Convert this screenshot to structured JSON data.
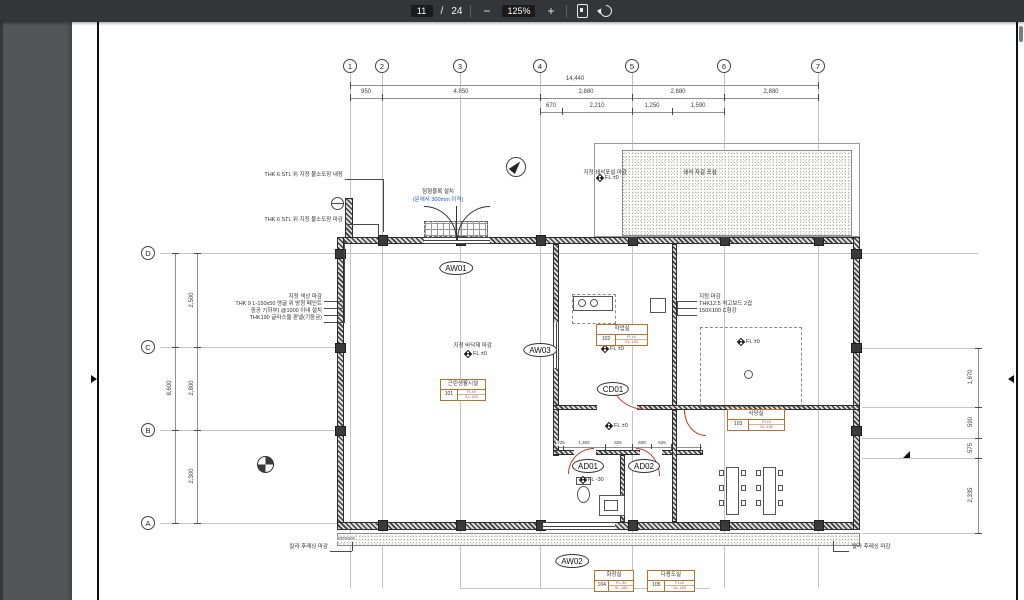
{
  "toolbar": {
    "page_current": "11",
    "page_separator": "/",
    "page_total": "24",
    "zoom_level": "125%",
    "zoom_out_label": "−",
    "zoom_in_label": "+"
  },
  "drawing": {
    "grid_cols": [
      {
        "label": "1",
        "x": 350
      },
      {
        "label": "2",
        "x": 382
      },
      {
        "label": "3",
        "x": 460
      },
      {
        "label": "4",
        "x": 540
      },
      {
        "label": "5",
        "x": 632
      },
      {
        "label": "6",
        "x": 724
      },
      {
        "label": "7",
        "x": 818
      }
    ],
    "grid_rows": [
      {
        "label": "D",
        "y": 253
      },
      {
        "label": "C",
        "y": 347
      },
      {
        "label": "B",
        "y": 430
      },
      {
        "label": "A",
        "y": 523
      }
    ],
    "dimensions": [
      {
        "t": "14,440",
        "x": 575,
        "y": 79
      },
      {
        "t": "950",
        "x": 366,
        "y": 92
      },
      {
        "t": "4,850",
        "x": 461,
        "y": 92
      },
      {
        "t": "2,880",
        "x": 586,
        "y": 92
      },
      {
        "t": "2,880",
        "x": 678,
        "y": 92
      },
      {
        "t": "2,880",
        "x": 771,
        "y": 92
      },
      {
        "t": "670",
        "x": 551,
        "y": 106
      },
      {
        "t": "2,210",
        "x": 597,
        "y": 106
      },
      {
        "t": "1,250",
        "x": 652,
        "y": 106
      },
      {
        "t": "1,590",
        "x": 698,
        "y": 106
      },
      {
        "t": "8,600",
        "x": 170,
        "y": 388,
        "rot": true
      },
      {
        "t": "2,500",
        "x": 192,
        "y": 300,
        "rot": true
      },
      {
        "t": "2,800",
        "x": 192,
        "y": 388,
        "rot": true
      },
      {
        "t": "2,300",
        "x": 192,
        "y": 476,
        "rot": true
      },
      {
        "t": "1,870",
        "x": 971,
        "y": 377,
        "rot": true
      },
      {
        "t": "590",
        "x": 971,
        "y": 422,
        "rot": true
      },
      {
        "t": "575",
        "x": 971,
        "y": 448,
        "rot": true
      },
      {
        "t": "2,335",
        "x": 971,
        "y": 495,
        "rot": true
      },
      {
        "t": "225",
        "x": 561,
        "y": 443,
        "tiny": true
      },
      {
        "t": "1,300",
        "x": 584,
        "y": 443,
        "tiny": true
      },
      {
        "t": "825",
        "x": 618,
        "y": 443,
        "tiny": true
      },
      {
        "t": "600",
        "x": 642,
        "y": 443,
        "tiny": true
      },
      {
        "t": "625",
        "x": 662,
        "y": 443,
        "tiny": true
      },
      {
        "t": "600X600",
        "x": 346,
        "y": 539,
        "tiny": true
      }
    ],
    "annotations": [
      {
        "t": "THK 6 STL 위 지정 불소도장 내장",
        "x": 343,
        "y": 176,
        "a": "r"
      },
      {
        "t": "THK 6 STL 위 지정 불소도장 마감",
        "x": 343,
        "y": 221,
        "a": "r"
      },
      {
        "t": "점형블록 설치",
        "x": 438,
        "y": 193,
        "a": "c"
      },
      {
        "t": "(문에서 300mm 이격)",
        "x": 438,
        "y": 201,
        "a": "c",
        "c": "#2456c9"
      },
      {
        "t": "지정 마감",
        "x": 699,
        "y": 298,
        "a": "l"
      },
      {
        "t": "THK12.5 석고보드 2겹",
        "x": 699,
        "y": 305,
        "a": "l"
      },
      {
        "t": "150X100 C형강",
        "x": 699,
        "y": 312,
        "a": "l"
      },
      {
        "t": "칼라 후레싱 마감",
        "x": 328,
        "y": 548,
        "a": "r"
      },
      {
        "t": "칼라 후레싱 마감",
        "x": 852,
        "y": 548,
        "a": "l"
      },
      {
        "t": "지정 쇄석포설 마감",
        "x": 627,
        "y": 174,
        "a": "r"
      },
      {
        "t": "쇄석 자갈 포설",
        "x": 700,
        "y": 174,
        "a": "c"
      },
      {
        "t": "지정 바닥재 마감",
        "x": 492,
        "y": 347,
        "a": "r"
      },
      {
        "t": "지정 색상 마감",
        "x": 322,
        "y": 298,
        "a": "r"
      },
      {
        "t": "THK 9 L-150x50 앵글 위 방청 페인트",
        "x": 322,
        "y": 305,
        "a": "r"
      },
      {
        "t": "중공 7(하부) @1000 이내 설치",
        "x": 322,
        "y": 312,
        "a": "r"
      },
      {
        "t": "THK190 글라스울 판넬(기둥금)",
        "x": 322,
        "y": 319,
        "a": "r"
      }
    ],
    "levels": [
      {
        "t": "FL ±0",
        "x": 597,
        "y": 179
      },
      {
        "t": "FL ±0",
        "x": 465,
        "y": 355
      },
      {
        "t": "FL ±0",
        "x": 602,
        "y": 350
      },
      {
        "t": "FL ±0",
        "x": 738,
        "y": 343
      },
      {
        "t": "FL ±0",
        "x": 606,
        "y": 427
      },
      {
        "t": "FL -30",
        "x": 580,
        "y": 481
      }
    ],
    "opening_tags": [
      {
        "t": "AW01",
        "x": 456,
        "y": 268
      },
      {
        "t": "AW03",
        "x": 540,
        "y": 350
      },
      {
        "t": "CD01",
        "x": 613,
        "y": 389
      },
      {
        "t": "AD01",
        "x": 588,
        "y": 466
      },
      {
        "t": "AD02",
        "x": 644,
        "y": 466
      },
      {
        "t": "AW02",
        "x": 572,
        "y": 561
      }
    ],
    "rooms": [
      {
        "name": "근린생활시설",
        "num": "101",
        "fl": "FL±0",
        "sl": "SL-150",
        "x": 440,
        "y": 379,
        "w": 46
      },
      {
        "name": "작업실",
        "num": "102",
        "fl": "FL±0",
        "sl": "SL-150",
        "x": 596,
        "y": 324,
        "w": 52
      },
      {
        "name": "식당실",
        "num": "103",
        "fl": "FL±0",
        "sl": "SL-150",
        "x": 727,
        "y": 409,
        "w": 58
      },
      {
        "name": "화장실",
        "num": "104",
        "fl": "FL-30",
        "sl": "SL-180",
        "x": 594,
        "y": 570,
        "w": 40
      },
      {
        "name": "다용도실",
        "num": "105",
        "fl": "FL±0",
        "sl": "SL-150",
        "x": 647,
        "y": 570,
        "w": 48
      }
    ]
  }
}
